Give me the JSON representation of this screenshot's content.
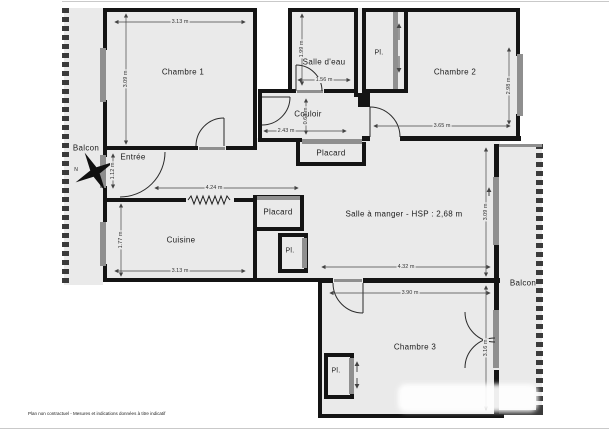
{
  "plan": {
    "footer": "Plan non contractuel - Mesures et indications données à titre indicatif",
    "compass": "N",
    "colors": {
      "wall": "#141414",
      "floor": "#eaeaea",
      "window": "#8f8f8f"
    },
    "balcony_left": {
      "name": "Balcon"
    },
    "balcony_right": {
      "name": "Balcon"
    },
    "rooms": {
      "chambre1": {
        "name": "Chambre 1",
        "dim_top": "3.13 m",
        "dim_left": "3.09 m"
      },
      "salle_eau": {
        "name": "Salle d'eau",
        "dim_left": "1.99 m",
        "dim_bottom": "1.56 m"
      },
      "pl_chambre2": {
        "name": "Pl."
      },
      "chambre2": {
        "name": "Chambre 2",
        "dim_bottom": "3.65 m",
        "dim_right": "2.98 m"
      },
      "couloir": {
        "name": "Couloir",
        "dim_width": "2.43 m",
        "dim_height": "0.64 m"
      },
      "placard_couloir": {
        "name": "Placard"
      },
      "entree": {
        "name": "Entrée",
        "dim_left": "1.12 m"
      },
      "hall": {
        "dim_top": "4.24 m"
      },
      "cuisine": {
        "name": "Cuisine",
        "dim_left": "1.77 m",
        "dim_bottom": "3.13 m"
      },
      "placard_sejour": {
        "name": "Placard"
      },
      "pl_sejour": {
        "name": "Pl."
      },
      "salle_a_manger": {
        "name": "Salle à manger - HSP : 2,68 m",
        "dim_bottom": "4.32 m",
        "dim_right": "3.09 m"
      },
      "chambre3": {
        "name": "Chambre 3",
        "dim_top": "3.90 m",
        "dim_right": "3.16 m"
      },
      "pl_chambre3": {
        "name": "Pl."
      }
    }
  }
}
